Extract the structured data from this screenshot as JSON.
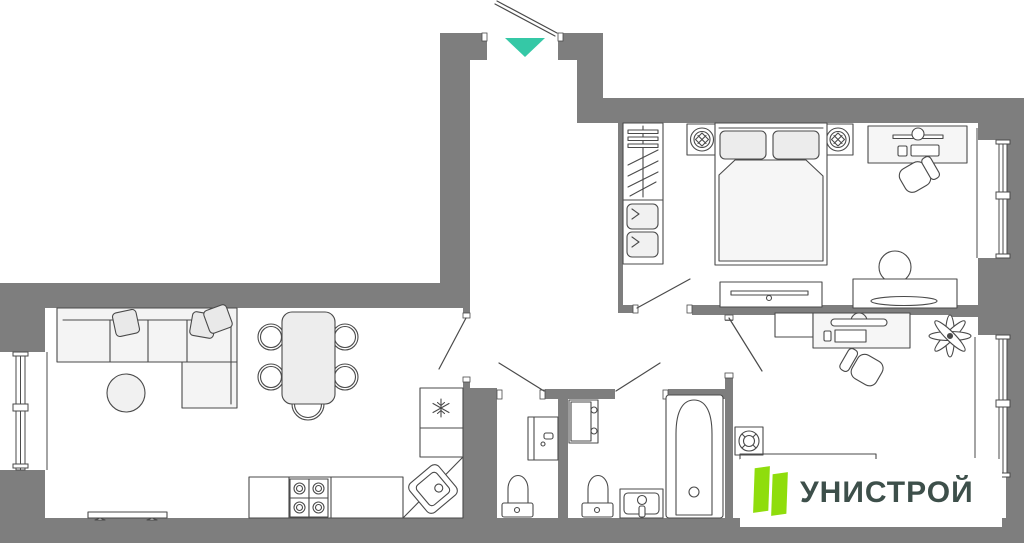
{
  "palette": {
    "wall": "#7E7E7E",
    "line": "#4A4A4A",
    "light_fill": "#EDEDED",
    "entrance_arrow": "#35C8A6",
    "logo_green": "#8FDD0C",
    "logo_text_color": "#3D4F4A",
    "background": "#FFFFFF"
  },
  "logo": {
    "text": "УНИСТРОЙ"
  },
  "plan": {
    "type": "apartment-floor-plan",
    "entrance": {
      "marker": "entrance-arrow",
      "direction": "down"
    },
    "windows": [
      "living-room-window",
      "bedroom-window",
      "office-window"
    ],
    "doors": [
      "building-entry-door-swing",
      "apartment-entrance-opening",
      "kitchen-door-swing",
      "wc-door-swing",
      "bathroom-door-swing",
      "bedroom-door-swing",
      "office-door-swing"
    ],
    "furniture": [
      "corner-sofa",
      "sofa-pillows",
      "coffee-table",
      "tv-panel",
      "dining-table",
      "dining-chairs",
      "kitchen-counter",
      "stove",
      "corner-sink",
      "refrigerator",
      "washing-machine",
      "wc-toilet",
      "bathroom-cabinet",
      "bathroom-toilet",
      "bathroom-sink",
      "bathtub",
      "ceiling-spotlight",
      "wardrobe",
      "double-bed",
      "pillows",
      "nightstand-left",
      "nightstand-right",
      "table-lamp",
      "dresser-tv",
      "dressing-table",
      "stool",
      "bedroom-desk",
      "bedroom-chair",
      "office-shelf",
      "office-desk",
      "office-chair",
      "plant",
      "office-wardrobe"
    ]
  }
}
